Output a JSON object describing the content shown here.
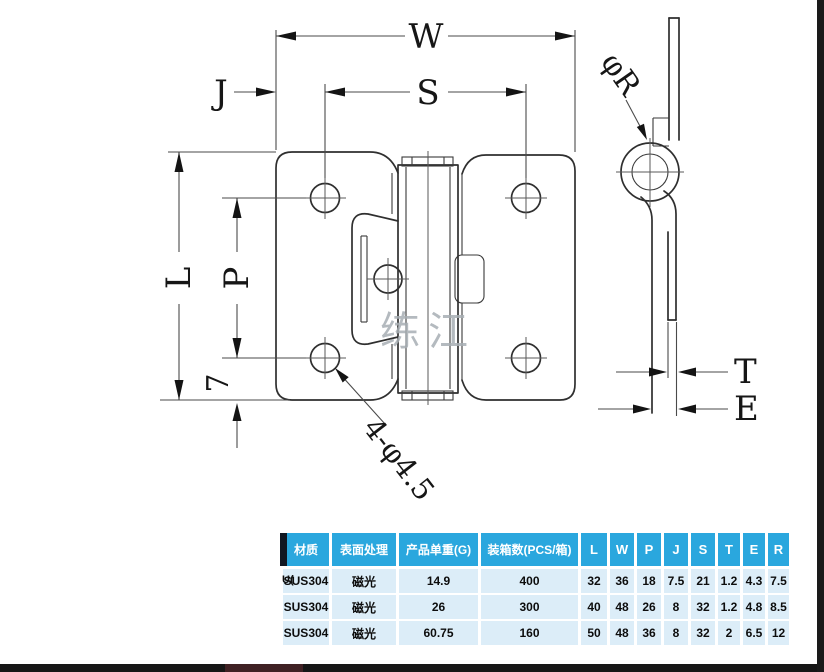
{
  "drawing": {
    "watermark_text": "练江",
    "labels": {
      "width": "W",
      "hole_span": "S",
      "edge_offset": "J",
      "length": "L",
      "hole_pitch": "P",
      "bottom_offset": "7",
      "holes_note": "4-φ4.5",
      "knuckle_dia": "φR",
      "thickness": "T",
      "end_offset": "E"
    }
  },
  "table": {
    "headers": [
      "材质",
      "表面处理",
      "产品单重(G)",
      "装箱数(PCS/箱)",
      "L",
      "W",
      "P",
      "J",
      "S",
      "T",
      "E",
      "R"
    ],
    "rows": [
      [
        "SUS304",
        "磁光",
        "14.9",
        "400",
        "32",
        "36",
        "18",
        "7.5",
        "21",
        "1.2",
        "4.3",
        "7.5"
      ],
      [
        "SUS304",
        "磁光",
        "26",
        "300",
        "40",
        "48",
        "26",
        "8",
        "32",
        "1.2",
        "4.8",
        "8.5"
      ],
      [
        "SUS304",
        "磁光",
        "60.75",
        "160",
        "50",
        "48",
        "36",
        "8",
        "32",
        "2",
        "6.5",
        "12"
      ]
    ],
    "artifact_prefix": "U(",
    "colors": {
      "header_bg": "#2AA7DE",
      "row_bg": "#DCEDF8",
      "edge_strip": "#101722",
      "bottom_bar": "#161616"
    }
  }
}
